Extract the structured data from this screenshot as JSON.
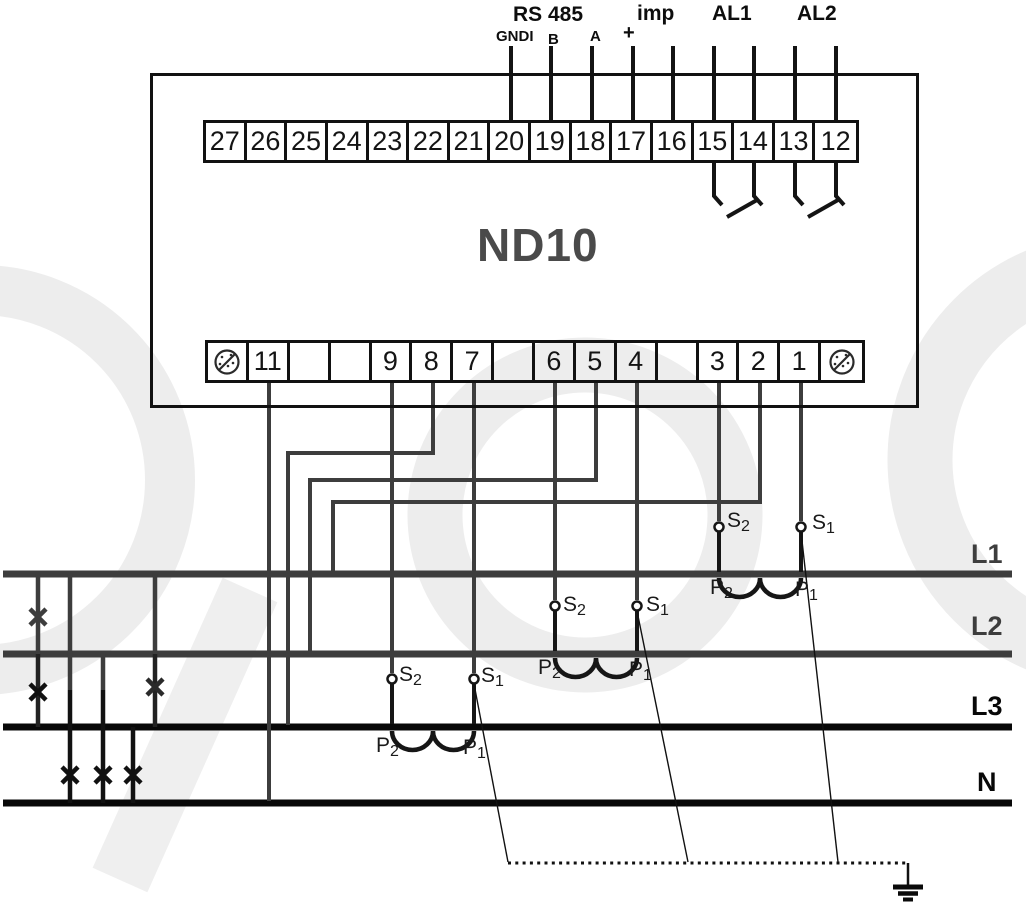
{
  "device": {
    "model": "ND10"
  },
  "top": {
    "rs485": "RS 485",
    "gnd": "GNDI",
    "b": "B",
    "a": "A",
    "plus": "+",
    "imp": "imp",
    "al1": "AL1",
    "al2": "AL2"
  },
  "terminals": {
    "top_row": [
      "27",
      "26",
      "25",
      "24",
      "23",
      "22",
      "21",
      "20",
      "19",
      "18",
      "17",
      "16",
      "15",
      "14",
      "13",
      "12"
    ],
    "bottom_row": [
      "",
      "11",
      "",
      "",
      "9",
      "8",
      "7",
      "",
      "6",
      "5",
      "4",
      "",
      "3",
      "2",
      "1",
      ""
    ]
  },
  "buses": {
    "l1": "L1",
    "l2": "L2",
    "l3": "L3",
    "n": "N"
  },
  "ct": {
    "s": "S",
    "p": "P",
    "sub1": "1",
    "sub2": "2"
  },
  "colors": {
    "wire_gray": "#3d3d3d",
    "wire_black": "#111111",
    "bus_gray": "#3d3d3d",
    "bus_black": "#080808",
    "watermark": "#ededed"
  }
}
